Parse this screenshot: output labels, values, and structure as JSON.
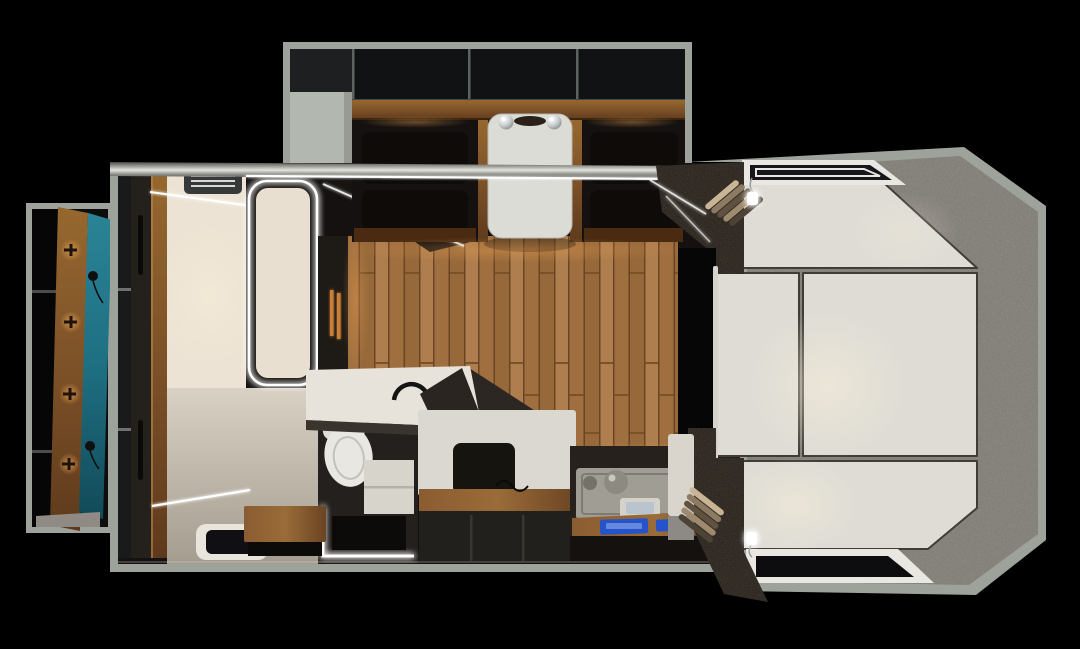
{
  "scene": {
    "type": "floorplan-3d-render",
    "view": "top-down-cutaway",
    "subject": "camper-interior",
    "background": "#000000"
  },
  "colors": {
    "shell": "#9da29b",
    "shell_light": "#b2b7af",
    "carpet": "#7e7a74",
    "mattress": "#dedcd5",
    "cushion_seam": "#403c37",
    "wood_floor": "#a87a49",
    "wood_trim_light": "#96682f",
    "wood_trim_dark": "#5e3a1c",
    "table": "#dcdcd6",
    "white_surface": "#e7e3da",
    "cream_wall": "#ece3d4",
    "entry_floor": "#cfc8bb",
    "charcoal": "#26211c",
    "sparkle_dark": "#241f1a",
    "black_opening": "#070606",
    "door_teal": "#1e6f82",
    "led": "#ffffff",
    "warm_glow": "#e09a4d",
    "screen_blue": "#2553c9",
    "steel": "#a09d94",
    "glass_dark": "#101014"
  },
  "regions": {
    "slideout": [
      "overhead-lockers",
      "storage-cabinet",
      "dinette-seat-left",
      "dinette-seat-right",
      "dinette-table",
      "pendant-lamp"
    ],
    "entry": [
      "entry-door-open",
      "coat-hooks",
      "door-panel-teal",
      "wardrobe",
      "ceiling-ac-vent",
      "floor-hatch",
      "led-strips"
    ],
    "bathroom": [
      "backlit-door",
      "vanity-counter",
      "faucet",
      "toilet",
      "step-shelf",
      "led-floor-edge",
      "step-stool"
    ],
    "galley": [
      "wood-floor",
      "bench-seat",
      "seat-cushion",
      "kitchen-counter",
      "sink",
      "kitchen-faucet",
      "control-screens"
    ],
    "bedroom": [
      "carpet-lining",
      "mattress-backrest",
      "mattress-left",
      "mattress-main",
      "mattress-foot",
      "roof-vent",
      "window",
      "reading-light-top",
      "reading-light-bottom",
      "curtain-top",
      "curtain-bottom",
      "privacy-divider"
    ]
  }
}
